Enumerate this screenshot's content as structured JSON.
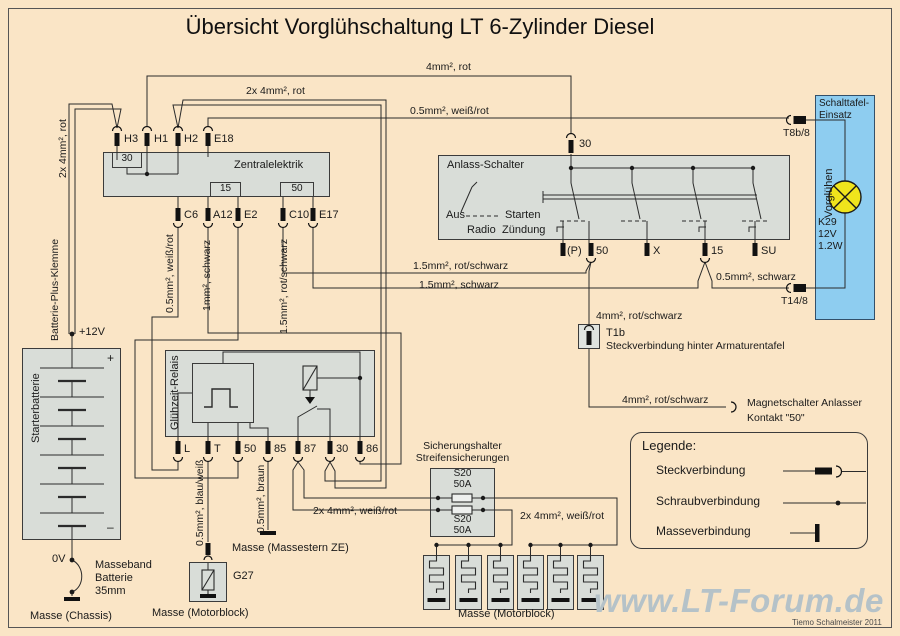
{
  "title": "Übersicht Vorglühschaltung LT 6-Zylinder Diesel",
  "battery": {
    "name": "Starterbatterie",
    "plus": "+",
    "minus": "–",
    "v12": "+12V",
    "v0": "0V",
    "clamp_label": "Batterie-Plus-Klemme",
    "wire_label": "2x 4mm², rot",
    "strap": "Masseband\nBatterie\n35mm",
    "ground": "Masse (Chassis)"
  },
  "ze": {
    "name": "Zentralelektrik",
    "bus30": "30",
    "box15": "15",
    "box50": "50",
    "top": [
      "H3",
      "H1",
      "H2",
      "E18"
    ],
    "bottom": [
      "C6",
      "A12",
      "E2",
      "C10",
      "E17"
    ]
  },
  "ze_wires": {
    "c6": "0.5mm², weiß/rot",
    "a12": "1mm², schwarz",
    "c10": "1.5mm², rot/schwarz"
  },
  "ignition": {
    "name": "Anlass-Schalter",
    "t30": "30",
    "aus": "Aus",
    "starten": "Starten",
    "radio": "Radio",
    "zuendung": "Zündung",
    "bottom": [
      "(P)",
      "50",
      "X",
      "15",
      "SU"
    ]
  },
  "panel": {
    "name": "Schalttafel-\nEinsatz",
    "vorgluehen": "Vorglühen",
    "lamp": "K29\n12V\n1.2W",
    "t8": "T8b/8",
    "t14": "T14/8"
  },
  "relay": {
    "name": "Glühzeit-Relais",
    "terminals": [
      "L",
      "T",
      "50",
      "85",
      "87",
      "30",
      "86"
    ]
  },
  "g27": {
    "label": "G27",
    "wire": "0.5mm², blau/weiß",
    "ground": "Masse (Motorblock)"
  },
  "massestern": {
    "wire": "0.5mm², braun",
    "label": "Masse (Massestern ZE)"
  },
  "fuses": {
    "title": "Sicherungshalter\nStreifensicherungen",
    "f1": "S20\n50A",
    "f2": "S20\n50A",
    "wire_left": "2x 4mm², weiß/rot",
    "wire_right": "2x 4mm², weiß/rot"
  },
  "plugs": {
    "ground": "Masse (Motorblock)"
  },
  "t1b": {
    "wire": "4mm², rot/schwarz",
    "label": "T1b",
    "desc": "Steckverbindung hinter Armaturentafel"
  },
  "magnet": {
    "wire": "4mm², rot/schwarz",
    "label": "Magnetschalter Anlasser\nKontakt \"50\""
  },
  "wires": {
    "w4rot": "4mm², rot",
    "w2x4rot": "2x 4mm², rot",
    "w05wr": "0.5mm², weiß/rot",
    "w15rs": "1.5mm², rot/schwarz",
    "w15s": "1.5mm², schwarz",
    "w05s": "0.5mm², schwarz"
  },
  "legend": {
    "title": "Legende:",
    "items": [
      "Steckverbindung",
      "Schraubverbindung",
      "Masseverbindung"
    ]
  },
  "watermark": "www.LT-Forum.de",
  "credit": "Tiemo Schalmeister 2011",
  "colors": {
    "background": "#fae5c6",
    "component_fill": "#d9ddd8",
    "panel_blue": "#8ecdf0",
    "lamp_yellow": "#f0e41c",
    "wire": "#2b2b2b",
    "watermark": "#b5c2c8"
  }
}
